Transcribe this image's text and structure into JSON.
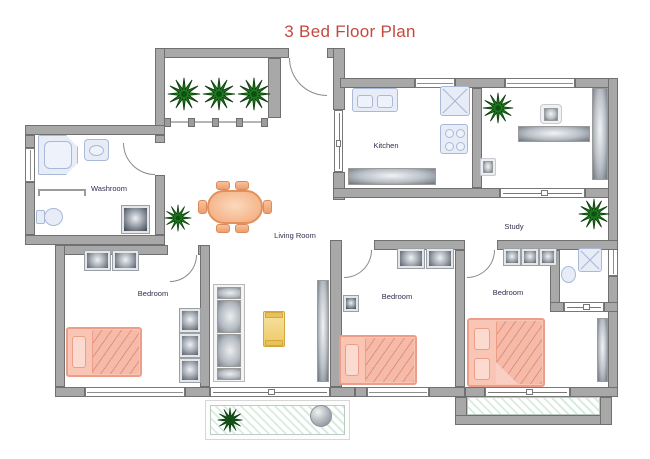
{
  "title": {
    "text": "3 Bed Floor Plan",
    "color": "#c5483f"
  },
  "rooms": {
    "washroom": "Washroom",
    "kitchen": "Kitchen",
    "study": "Study",
    "living_room": "Living Room",
    "bedroom_left": "Bedroom",
    "bedroom_middle": "Bedroom",
    "bedroom_right": "Bedroom"
  },
  "colors": {
    "wall_fill": "#a8a8a8",
    "wall_border": "#707070",
    "fixture_fill": "#e7ecf7",
    "fixture_border": "#a9b9d8",
    "bed_fill": "#f9c6b6",
    "bed_border": "#ee9d89",
    "dining_table_orange": "#f3a878",
    "coffee_table_yellow": "#eec964",
    "plant_green": "#1d7a1d",
    "porch_hatch_green": "#d8ece0",
    "label_text": "#2e2e4e",
    "title_red": "#c5483f"
  }
}
